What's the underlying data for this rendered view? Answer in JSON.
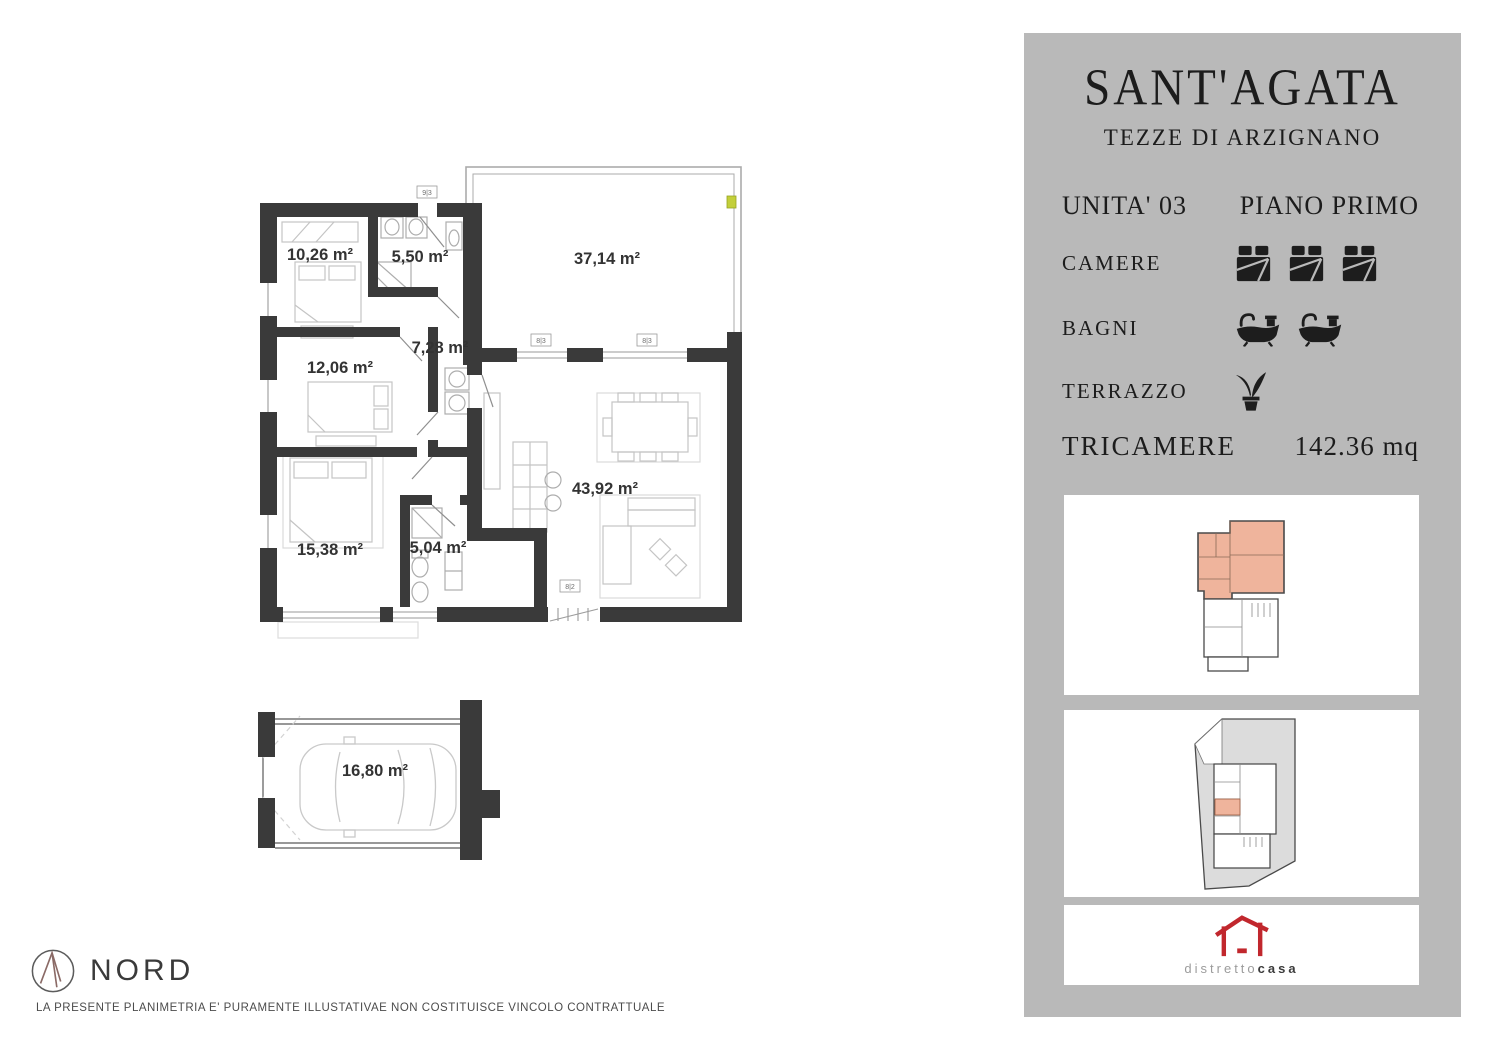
{
  "panel": {
    "title": "SANT'AGATA",
    "subtitle": "TEZZE DI ARZIGNANO",
    "unit": "UNITA' 03",
    "floor": "PIANO PRIMO",
    "rows": {
      "camere": "CAMERE",
      "bagni": "BAGNI",
      "terrazzo": "TERRAZZO",
      "type": "TRICAMERE",
      "area": "142.36 mq"
    },
    "counts": {
      "camere": 3,
      "bagni": 2,
      "terrazzo": 1
    }
  },
  "logo": {
    "part1": "distretto",
    "part2": "casa"
  },
  "plan": {
    "labels": {
      "bedroom1": "10,26 m²",
      "bath1": "5,50 m²",
      "terrace": "37,14 m²",
      "bedroom2": "12,06 m²",
      "hall": "7,28 m²",
      "bedroom3": "15,38 m²",
      "bath2": "5,04 m²",
      "living": "43,92 m²",
      "garage": "16,80 m²"
    },
    "markers": {
      "m1": "9|3",
      "m2": "8|3",
      "m3": "8|3",
      "m4": "8|2"
    }
  },
  "footer": {
    "north": "NORD",
    "disclaimer": "LA PRESENTE PLANIMETRIA E' PURAMENTE ILLUSTATIVAE NON COSTITUISCE VINCOLO CONTRATTUALE"
  },
  "colors": {
    "panel_bg": "#b9b9b9",
    "wall": "#3a3a3a",
    "highlight": "#efb49c",
    "logo_red": "#c1272d"
  }
}
